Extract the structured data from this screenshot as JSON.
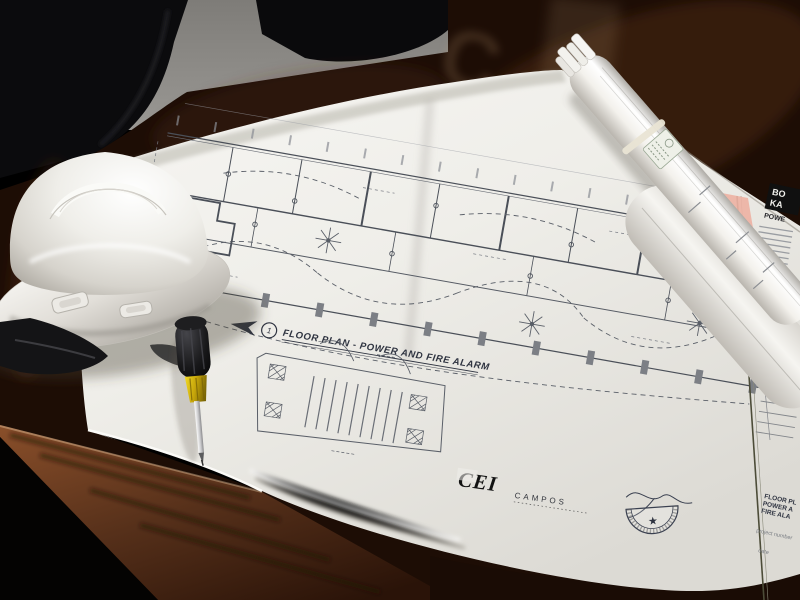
{
  "scene": {
    "description": "White hard hat, screwdriver and rolled-up drawings lying on an unrolled electrical floor-plan blueprint on a dark polished conference table",
    "setting": "office conference room with gray wall and black chairs",
    "reflection_glyph": "C",
    "objects": {
      "hard_hat": "white construction hard hat",
      "screwdriver": "black and yellow screwdriver",
      "rolled_plans": "rolled blueprint set with rubber band and label",
      "blueprint_sheet": "unrolled floor plan sheet",
      "pink_sheet": "pink sheet corner in drawing stack",
      "table": "dark polished wood conference table",
      "chairs": "black office chairs",
      "wall": "gray wall"
    }
  },
  "drawing": {
    "callout": {
      "number": "1",
      "title": "FLOOR PLAN - POWER AND FIRE ALARM"
    },
    "firm": {
      "logo": "CEI",
      "name": "CAMPOS"
    },
    "seal": {
      "star_glyph": "★"
    },
    "title_block": {
      "sheet_title_line1": "FLOOR PL",
      "sheet_title_line2": "POWER A",
      "sheet_title_line3": "FIRE ALA",
      "project_label": "project number",
      "date_label": "date"
    },
    "corner_logo": {
      "line1": "BO",
      "line2": "KA",
      "line3": "POWE"
    }
  },
  "colors": {
    "paper": "#f0efeb",
    "ink": "#4a4f58",
    "wood_dark": "#1d0d05",
    "wood_edge": "#6b3a1e",
    "wall": "#8b8985",
    "hat": "#f2f1ed",
    "pink": "#edb2a4",
    "yellow": "#d4b300"
  }
}
